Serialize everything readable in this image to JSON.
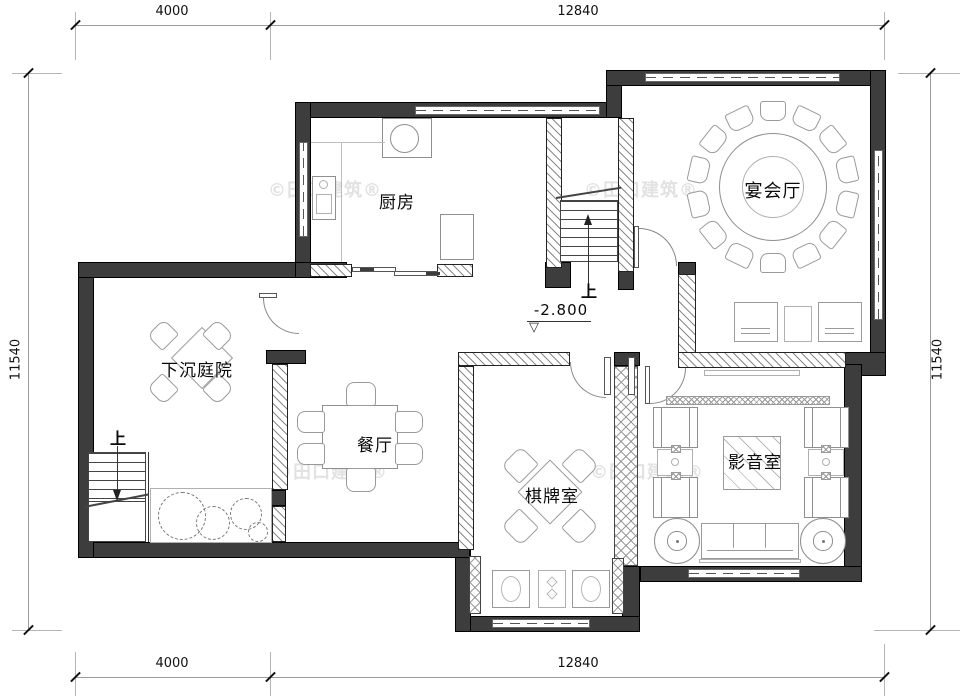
{
  "plan": {
    "watermark_text": "©田口建筑®",
    "rooms": {
      "kitchen": "厨房",
      "banquet_hall": "宴会厅",
      "sunken_courtyard": "下沉庭院",
      "dining_room": "餐厅",
      "chess_room": "棋牌室",
      "media_room": "影音室"
    },
    "annotations": {
      "stair_up": "上",
      "elevation": "-2.800",
      "elevation_symbol": "▽"
    },
    "dimensions": {
      "top": [
        "4000",
        "12840"
      ],
      "bottom": [
        "4000",
        "12840"
      ],
      "left": "11540",
      "right": "11540"
    },
    "colors": {
      "wall": "#3d3d3d",
      "line": "#000000",
      "furniture_line": "#9a9a9a",
      "dimension_line": "#9b9b9b",
      "text": "#0a0a0a",
      "watermark": "#e2e2e2"
    }
  }
}
